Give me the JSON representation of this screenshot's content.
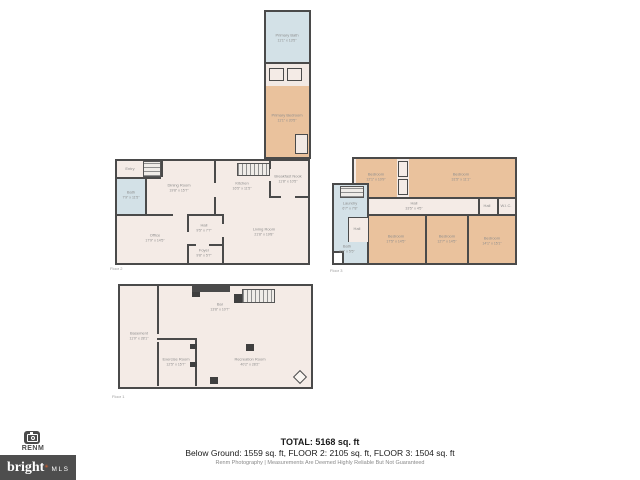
{
  "colors": {
    "wall": "#4a4a4a",
    "room_base": "#f4ebe6",
    "room_bedroom": "#eac29d",
    "room_bath": "#d3e1e7",
    "label_text": "#8d8d8d",
    "logo_background": "#4e4e4e",
    "logo_accent": "#e8632a"
  },
  "wing": {
    "primary_bath": {
      "name": "Primary Bath",
      "dims": "11'1\" x 13'5\""
    },
    "primary_bedroom": {
      "name": "Primary Bedroom",
      "dims": "11'1\" x 20'5\""
    }
  },
  "floor2": {
    "caption": "Floor 2",
    "rooms": {
      "entry": {
        "name": "Entry",
        "dims": "7'6\" x 4'9\""
      },
      "bath": {
        "name": "Bath",
        "dims": "7'9\" x 11'5\""
      },
      "dining": {
        "name": "Dining Room",
        "dims": "19'8\" x 15'7\""
      },
      "kitchen": {
        "name": "Kitchen",
        "dims": "16'5\" x 11'5\""
      },
      "nook": {
        "name": "Breakfast Nook",
        "dims": "11'8\" x 10'5\""
      },
      "hall": {
        "name": "Hall",
        "dims": "9'5\" x 7'7\""
      },
      "office": {
        "name": "Office",
        "dims": "17'9\" x 14'5\""
      },
      "foyer": {
        "name": "Foyer",
        "dims": "9'8\" x 5'7\""
      },
      "living": {
        "name": "Living Room",
        "dims": "21'8\" x 19'8\""
      }
    }
  },
  "floor3": {
    "caption": "Floor 3",
    "rooms": {
      "laundry": {
        "name": "Laundry",
        "dims": "6'7\" x 7'8\""
      },
      "annex_hall": {
        "name": "Hall",
        "dims": "5'5\" x 7'5\""
      },
      "bath": {
        "name": "Bath",
        "dims": "8'8\" x 5'5\""
      },
      "bedroom_tl": {
        "name": "Bedroom",
        "dims": "12'1\" x 10'9\""
      },
      "bedroom_tr": {
        "name": "Bedroom",
        "dims": "31'5\" x 11'1\""
      },
      "hall": {
        "name": "Hall",
        "dims": "33'5\" x 4'5\""
      },
      "hall2": {
        "name": "Hall",
        "dims": "5'5\" x 4'5\""
      },
      "wic": {
        "name": "W.I.C.",
        "dims": "5'1\" x 4'5\""
      },
      "bedroom_b1": {
        "name": "Bedroom",
        "dims": "17'5\" x 14'5\""
      },
      "bedroom_b2": {
        "name": "Bedroom",
        "dims": "12'7\" x 14'5\""
      },
      "bedroom_b3": {
        "name": "Bedroom",
        "dims": "14'1\" x 15'1\""
      }
    }
  },
  "floor1": {
    "caption": "Floor 1",
    "rooms": {
      "basement": {
        "name": "Basement",
        "dims": "11'0\" x 28'1\""
      },
      "bar": {
        "name": "Bar",
        "dims": "13'8\" x 10'7\""
      },
      "exercise": {
        "name": "Exercise Room",
        "dims": "12'5\" x 15'7\""
      },
      "recreation": {
        "name": "Recreation Room",
        "dims": "40'2\" x 28'2\""
      }
    }
  },
  "footer": {
    "total_line": "TOTAL: 5168 sq. ft",
    "breakdown_line": "Below Ground: 1559 sq. ft, FLOOR 2: 2105 sq. ft, FLOOR 3: 1504 sq. ft",
    "disclaimer_line": "Renm Photography | Measurements Are Deemed Highly Reliable But Not Guaranteed"
  },
  "branding": {
    "photographer": "RENM",
    "logo_text": "bright",
    "logo_mark": "✳",
    "logo_suffix": "MLS"
  }
}
